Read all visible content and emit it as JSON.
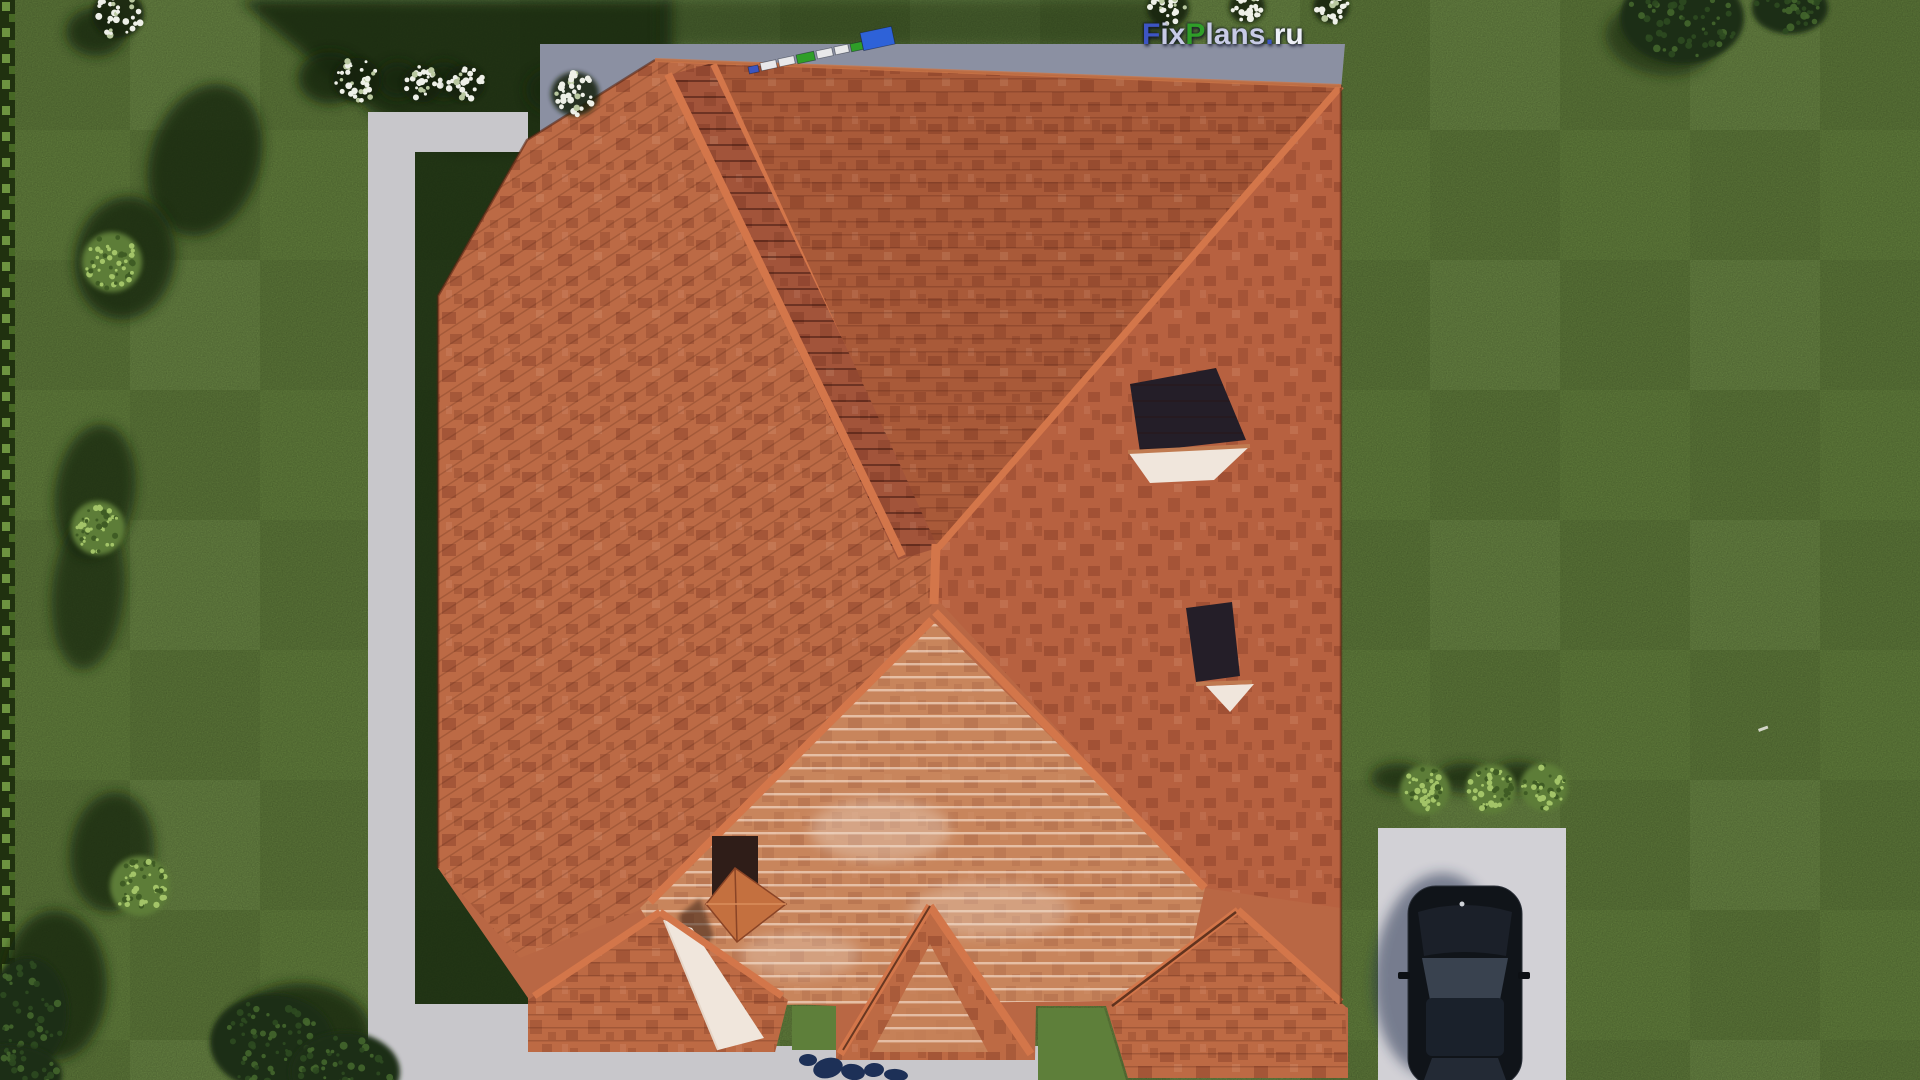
{
  "scene_description": "Aerial top-down 3D render of a house with terracotta hip roof, lawn, concrete paths, driveway with black car, bushes and trees",
  "watermark": {
    "full": "FixPlans.ru",
    "parts": [
      {
        "t": "F",
        "c": "#3d55c4"
      },
      {
        "t": "ix",
        "c": "#c8cbe6"
      },
      {
        "t": "P",
        "c": "#2f9e28"
      },
      {
        "t": "lans",
        "c": "#c8cbe6"
      },
      {
        "t": ".",
        "c": "#3d55c4"
      },
      {
        "t": "ru",
        "c": "#edeff7"
      }
    ]
  },
  "colors": {
    "lawn": "#66843f",
    "lawn_bright": "#5e7f3a",
    "shadow": "#15270e",
    "hedge": "#20310f",
    "hedge_light": "#8abb4e",
    "path": "#c8c7cb",
    "path_shadow": "#9aa0b0",
    "apron": "#8b90a2",
    "driveway": "#d2d1d6",
    "roof_base": "#b96744",
    "roof_left": "#bc6a45",
    "roof_top": "#a95a39",
    "roof_right": "#b76140",
    "roof_band": "#a2543a",
    "roof_light": "#c8855c",
    "roof_proj": "#bd6a44",
    "ridge": "#d3764a",
    "eave_line": "#5a2714",
    "glass": "#241e28",
    "sill": "#f0e6dc",
    "chimney": "#2f1d18",
    "chimney_cap": "#c4703f",
    "car_body": "#101419",
    "car_roof": "#1a212b",
    "car_glass": "#39424f",
    "car_shadow": "#1d2b4a",
    "flower_white": "#eef0e8",
    "flower_dim": "#b9c8a0",
    "bush_green": "#5d7d37",
    "bush_speckle": "#a3c468",
    "tree_dark": "#1c2e14",
    "remnant_blue": "#1d3057"
  },
  "scene": {
    "white_bushes": [
      {
        "x": 118,
        "y": 14,
        "r": 26
      },
      {
        "x": 357,
        "y": 80,
        "r": 24
      },
      {
        "x": 422,
        "y": 84,
        "r": 20
      },
      {
        "x": 465,
        "y": 83,
        "r": 20
      },
      {
        "x": 575,
        "y": 94,
        "r": 24
      },
      {
        "x": 1168,
        "y": 8,
        "r": 21
      },
      {
        "x": 1247,
        "y": 7,
        "r": 18
      },
      {
        "x": 1331,
        "y": 7,
        "r": 18
      }
    ],
    "green_bushes": [
      {
        "x": 112,
        "y": 262,
        "r": 30
      },
      {
        "x": 98,
        "y": 528,
        "r": 27
      },
      {
        "x": 140,
        "y": 886,
        "r": 30
      },
      {
        "x": 1425,
        "y": 790,
        "r": 25
      },
      {
        "x": 1491,
        "y": 789,
        "r": 25
      },
      {
        "x": 1544,
        "y": 787,
        "r": 24
      }
    ],
    "trees": [
      {
        "x": 1682,
        "y": 18,
        "rx": 62,
        "ry": 46
      },
      {
        "x": 1790,
        "y": 8,
        "rx": 38,
        "ry": 26
      },
      {
        "x": 272,
        "y": 1042,
        "rx": 62,
        "ry": 48
      },
      {
        "x": 345,
        "y": 1072,
        "rx": 55,
        "ry": 40
      },
      {
        "x": 28,
        "y": 1012,
        "rx": 40,
        "ry": 55
      },
      {
        "x": 12,
        "y": 1075,
        "rx": 50,
        "ry": 30
      }
    ],
    "lawn_shadows": [
      {
        "x": 205,
        "y": 160,
        "rx": 55,
        "ry": 78,
        "rot": 18,
        "o": 0.8
      },
      {
        "x": 125,
        "y": 258,
        "rx": 50,
        "ry": 62,
        "rot": 10,
        "o": 0.8
      },
      {
        "x": 95,
        "y": 492,
        "rx": 40,
        "ry": 68,
        "rot": 8,
        "o": 0.75
      },
      {
        "x": 88,
        "y": 592,
        "rx": 36,
        "ry": 78,
        "rot": 5,
        "o": 0.7
      },
      {
        "x": 112,
        "y": 852,
        "rx": 42,
        "ry": 60,
        "rot": 6,
        "o": 0.75
      },
      {
        "x": 55,
        "y": 985,
        "rx": 52,
        "ry": 75,
        "rot": 0,
        "o": 0.8
      },
      {
        "x": 300,
        "y": 1035,
        "rx": 72,
        "ry": 52,
        "rot": 0,
        "o": 0.8
      },
      {
        "x": 330,
        "y": 78,
        "rx": 32,
        "ry": 26,
        "rot": 0,
        "o": 0.85
      },
      {
        "x": 398,
        "y": 80,
        "rx": 20,
        "ry": 18,
        "rot": 0,
        "o": 0.8
      },
      {
        "x": 444,
        "y": 80,
        "rx": 20,
        "ry": 18,
        "rot": 0,
        "o": 0.8
      },
      {
        "x": 552,
        "y": 90,
        "rx": 26,
        "ry": 22,
        "rot": 0,
        "o": 0.7
      },
      {
        "x": 96,
        "y": 32,
        "rx": 30,
        "ry": 24,
        "rot": 0,
        "o": 0.8
      },
      {
        "x": 1660,
        "y": 40,
        "rx": 55,
        "ry": 35,
        "rot": 10,
        "o": 0.6
      },
      {
        "x": 1398,
        "y": 778,
        "rx": 27,
        "ry": 15,
        "rot": 0,
        "o": 0.75
      },
      {
        "x": 1464,
        "y": 778,
        "rx": 27,
        "ry": 15,
        "rot": 0,
        "o": 0.75
      },
      {
        "x": 1518,
        "y": 777,
        "rx": 26,
        "ry": 15,
        "rot": 0,
        "o": 0.75
      }
    ],
    "ruler_segments": [
      {
        "x": 748,
        "y": 67,
        "w": 10,
        "h": 7,
        "rot": -12,
        "c": "#3a55c0"
      },
      {
        "x": 760,
        "y": 63,
        "w": 16,
        "h": 8,
        "rot": -12,
        "c": "#e8e8ea"
      },
      {
        "x": 778,
        "y": 59,
        "w": 16,
        "h": 8,
        "rot": -12,
        "c": "#e8e8ea"
      },
      {
        "x": 796,
        "y": 55,
        "w": 18,
        "h": 9,
        "rot": -12,
        "c": "#2f9e28"
      },
      {
        "x": 816,
        "y": 51,
        "w": 16,
        "h": 8,
        "rot": -12,
        "c": "#e8e8ea"
      },
      {
        "x": 834,
        "y": 47,
        "w": 14,
        "h": 8,
        "rot": -12,
        "c": "#e8e8ea"
      },
      {
        "x": 850,
        "y": 44,
        "w": 12,
        "h": 8,
        "rot": -12,
        "c": "#2f9e28"
      },
      {
        "x": 860,
        "y": 33,
        "w": 32,
        "h": 18,
        "rot": -12,
        "c": "#2e62d8"
      }
    ],
    "remnant_blobs": [
      {
        "x": 828,
        "y": 1068,
        "rx": 15,
        "ry": 10,
        "rot": -15
      },
      {
        "x": 853,
        "y": 1072,
        "rx": 12,
        "ry": 8,
        "rot": 10
      },
      {
        "x": 874,
        "y": 1070,
        "rx": 10,
        "ry": 7,
        "rot": -5
      },
      {
        "x": 896,
        "y": 1075,
        "rx": 12,
        "ry": 6,
        "rot": 5
      },
      {
        "x": 808,
        "y": 1060,
        "rx": 9,
        "ry": 6,
        "rot": 0
      }
    ],
    "tiny_mark": {
      "x": 1758,
      "y": 729,
      "w": 10,
      "h": 3,
      "rot": -20
    }
  }
}
